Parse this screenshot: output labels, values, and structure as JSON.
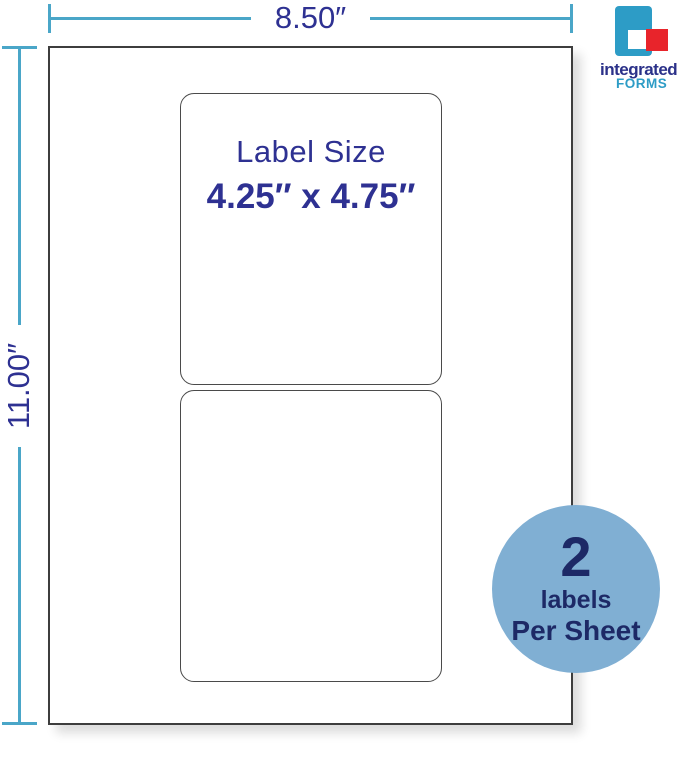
{
  "dimensions": {
    "sheet_width": "8.50″",
    "sheet_height": "11.00″"
  },
  "label": {
    "title": "Label Size",
    "size": "4.25″ x 4.75″"
  },
  "badge": {
    "count": "2",
    "unit": "labels",
    "per": "Per Sheet"
  },
  "logo": {
    "name": "integrated",
    "division": "FORMS"
  },
  "colors": {
    "dimension_line": "#4AA6C8",
    "navy_text": "#2E3192",
    "sheet_border": "#3D3D3D",
    "label_border": "#4A4A4A",
    "badge_background": "#80AFD3",
    "badge_text": "#1D2966",
    "logo_blue": "#2D9CC6",
    "logo_red": "#E8242B",
    "logo_navy": "#2B3189"
  }
}
